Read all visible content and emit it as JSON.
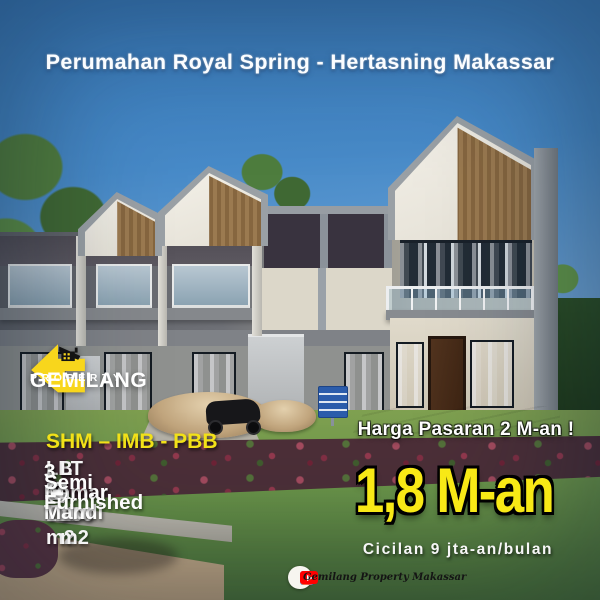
{
  "poster": {
    "title": "Perumahan Royal Spring - Hertasning Makassar",
    "logo": {
      "name": "GEMILANG",
      "tagline": "PROPERTY"
    },
    "legal": "SHM – IMB - PBB",
    "building_area": "LB : 115 m2",
    "land_area": "LT : 160 m2",
    "features": [
      {
        "icon": "bed-icon",
        "label": "3 Kamar Tidur"
      },
      {
        "icon": "bath-icon",
        "label": "3 Kamar Mandi"
      },
      {
        "icon": "furnished-icon",
        "label": "Semi Furnished"
      }
    ],
    "market_price": "Harga Pasaran 2 M-an !",
    "price": "1,8 M-an",
    "installment": "Cicilan 9 jta-an/bulan",
    "footer": {
      "social_icons": [
        "facebook-icon",
        "instagram-icon",
        "youtube-icon"
      ],
      "facebook_glyph": "f",
      "account": "Gemilang Property Makassar"
    },
    "colors": {
      "accent_yellow": "#f8e916",
      "logo_yellow": "#f8d61c",
      "sky_blue": "#478ac8",
      "facebook_blue": "#1877f2",
      "youtube_red": "#ff0000"
    }
  }
}
